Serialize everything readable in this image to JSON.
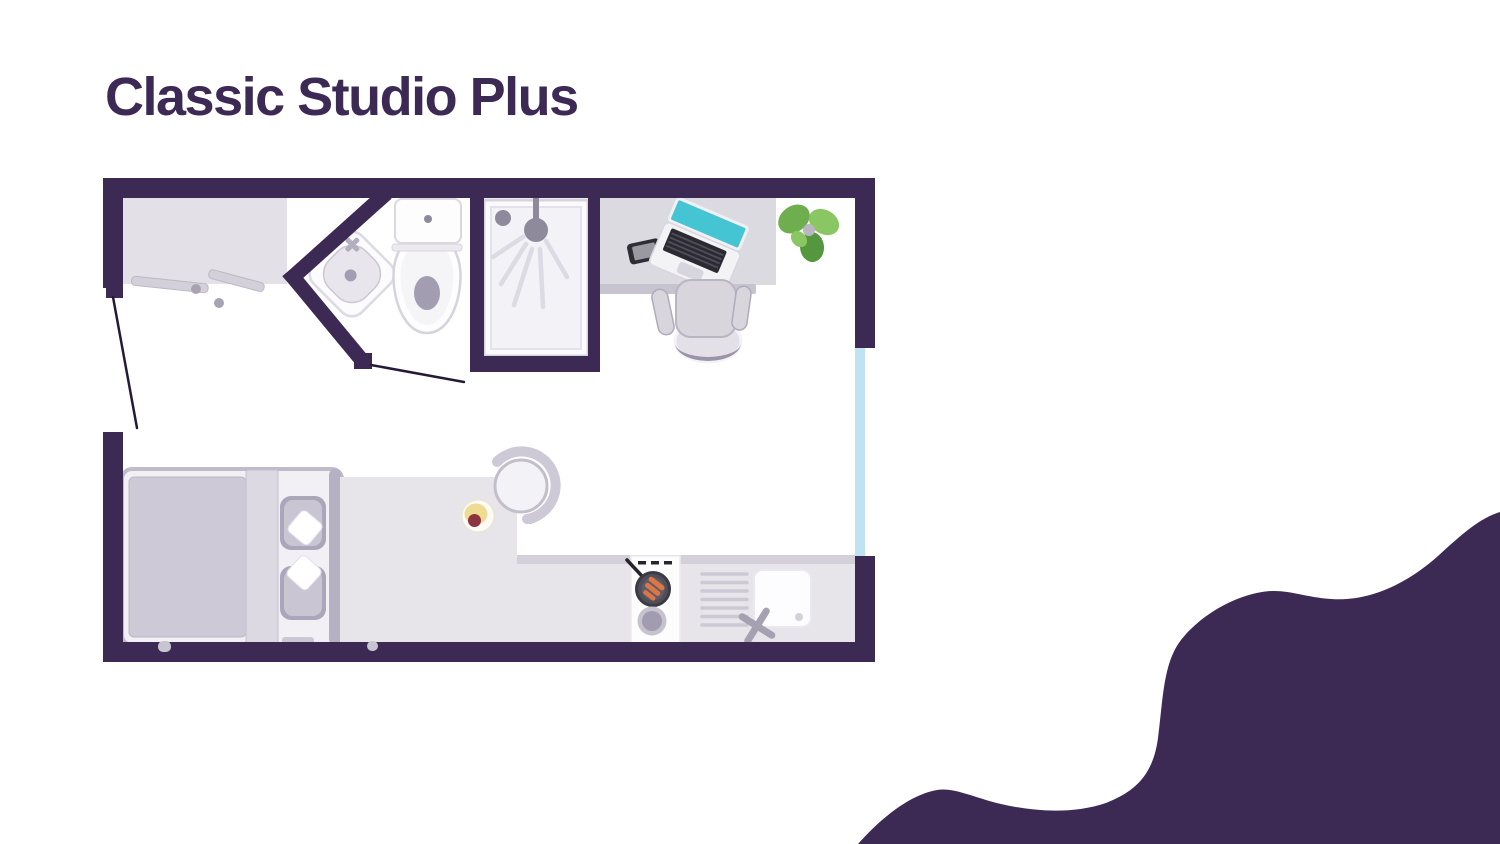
{
  "title": "Classic Studio Plus",
  "colors": {
    "ink": "#3c2a55",
    "wall": "#3c2a55",
    "background": "#ffffff",
    "window": "#bfe3f1",
    "furniture-light": "#e7e5ea",
    "furniture-mid": "#cdc9d6",
    "furniture-dark": "#b6b1c1",
    "fixture-white": "#fdfdfe",
    "screen-teal": "#45c5d3",
    "green-light": "#8ac763",
    "green-mid": "#6fae4f",
    "green-dark": "#55973f",
    "bacon-orange": "#dd7645",
    "food-yellow": "#eedc92",
    "food-red": "#8e3340",
    "door-line": "#241a38"
  },
  "floor_plan": {
    "name": "Classic Studio Plus floor plan",
    "rooms": [
      "studio room",
      "bathroom"
    ],
    "furniture": [
      "wardrobe",
      "entrance-door",
      "bed",
      "pillows",
      "corner-sink",
      "toilet",
      "shower",
      "desk",
      "laptop",
      "smartphone",
      "office-chair",
      "plant",
      "dining-table",
      "dining-chair",
      "plate-of-food",
      "kitchen-counter",
      "hob",
      "frying-pan",
      "saucepan",
      "draining-board",
      "kitchen-sink",
      "tap",
      "window",
      "bathroom-door"
    ]
  }
}
